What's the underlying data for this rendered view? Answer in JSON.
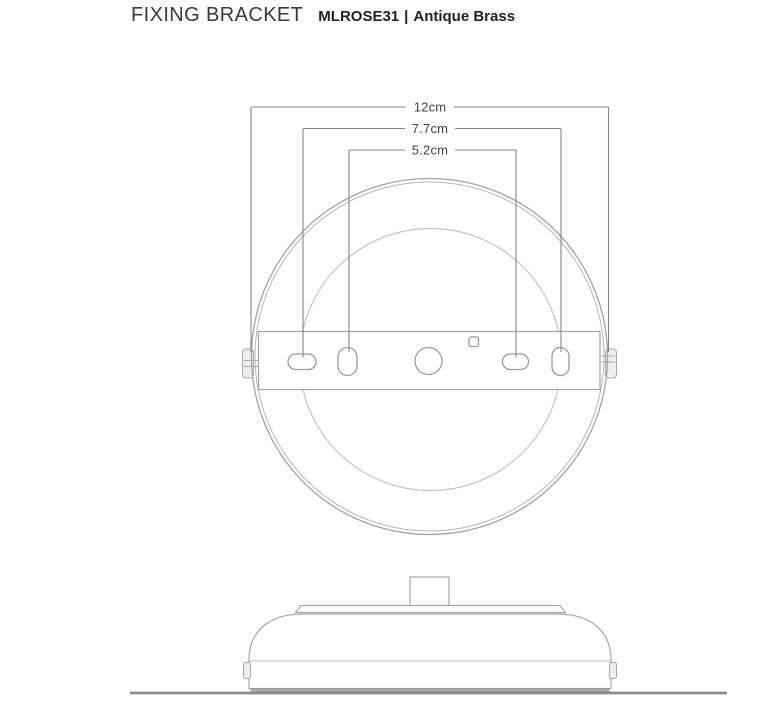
{
  "header": {
    "title": "FIXING BRACKET",
    "product_code": "MLROSE31",
    "separator": "|",
    "finish": "Antique Brass"
  },
  "drawing": {
    "views": [
      "top-view",
      "side-profile"
    ],
    "dimensions": {
      "overall_diameter": "12cm",
      "outer_fixing_centres": "7.7cm",
      "inner_fixing_centres": "5.2cm"
    }
  }
}
